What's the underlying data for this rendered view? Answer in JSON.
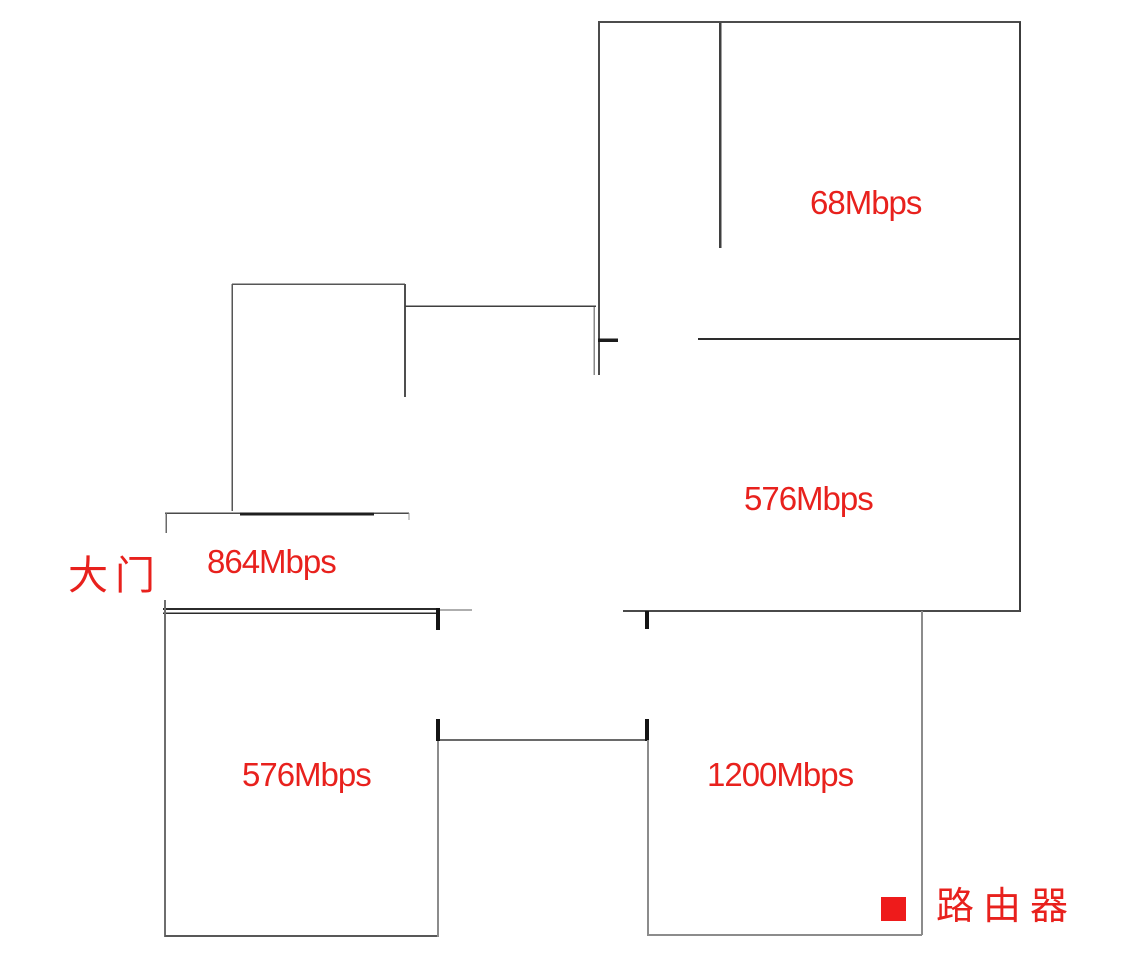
{
  "colors": {
    "label_red": "#e8211d",
    "router_red": "#ee1b1b"
  },
  "rooms": [
    {
      "id": "top-right-room",
      "speed": "68Mbps"
    },
    {
      "id": "middle-right-room",
      "speed": "576Mbps"
    },
    {
      "id": "entry-hall",
      "speed": "864Mbps"
    },
    {
      "id": "bottom-left-room",
      "speed": "576Mbps"
    },
    {
      "id": "bottom-right-room",
      "speed": "1200Mbps"
    }
  ],
  "annotations": {
    "front_door": "大门",
    "router": "路由器"
  }
}
